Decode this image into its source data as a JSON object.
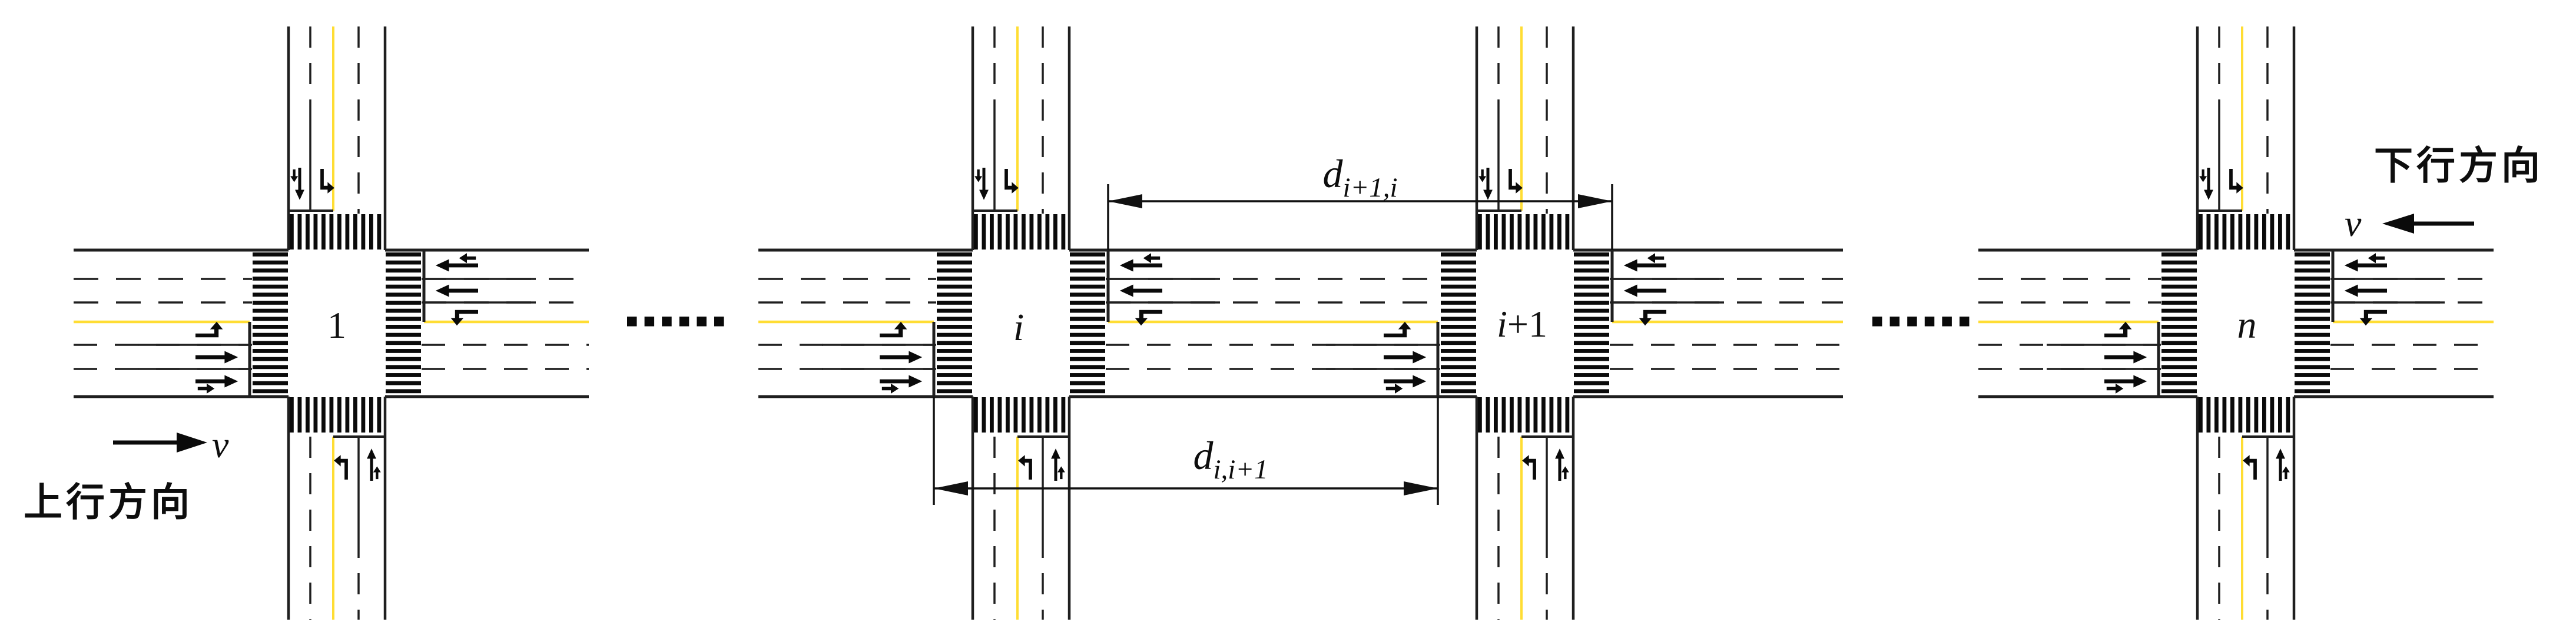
{
  "intersections": [
    {
      "id": "intersection-1",
      "label_it": "",
      "label_plain": "1"
    },
    {
      "id": "intersection-i",
      "label_it": "i",
      "label_plain": ""
    },
    {
      "id": "intersection-i-plus-1",
      "label_it": "i",
      "label_plain": "+1"
    },
    {
      "id": "intersection-n",
      "label_it": "n",
      "label_plain": ""
    }
  ],
  "dimensions": {
    "top": {
      "base": "d",
      "sub": "i+1,i"
    },
    "bottom": {
      "base": "d",
      "sub": "i,i+1"
    }
  },
  "directions": {
    "upstream": {
      "label": "上行方向",
      "speed_symbol": "v"
    },
    "downstream": {
      "label": "下行方向",
      "speed_symbol": "v"
    }
  },
  "ellipsis": {
    "left": "......",
    "right": "......",
    "count": 6
  },
  "lane_markings": {
    "eastbound": [
      "left-turn-arrow",
      "straight-arrow",
      "straight-uturn-arrow"
    ],
    "westbound": [
      "straight-uturn-arrow",
      "straight-arrow",
      "left-turn-arrow"
    ],
    "northbound": [
      "left-turn-arrow",
      "straight-uturn-arrow"
    ],
    "southbound": [
      "straight-uturn-arrow",
      "left-turn-arrow"
    ]
  },
  "colors": {
    "line": "#1f1f1f",
    "marking": "#0a0a0a",
    "yellow": "#ffdd33",
    "background": "#ffffff"
  }
}
